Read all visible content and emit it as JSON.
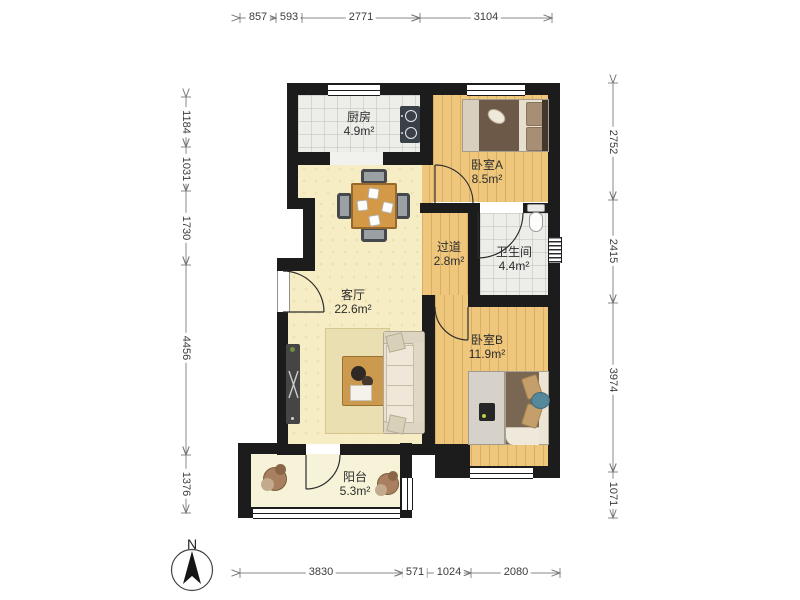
{
  "figure": {
    "type": "apartment-floor-plan"
  },
  "rooms": [
    {
      "id": "kitchen",
      "name": "厨房",
      "area": "4.9m²"
    },
    {
      "id": "bedroom-a",
      "name": "卧室A",
      "area": "8.5m²"
    },
    {
      "id": "hallway",
      "name": "过道",
      "area": "2.8m²"
    },
    {
      "id": "bathroom",
      "name": "卫生间",
      "area": "4.4m²"
    },
    {
      "id": "living-room",
      "name": "客厅",
      "area": "22.6m²"
    },
    {
      "id": "bedroom-b",
      "name": "卧室B",
      "area": "11.9m²"
    },
    {
      "id": "balcony",
      "name": "阳台",
      "area": "5.3m²"
    }
  ],
  "dimensions_mm": {
    "top": [
      "857",
      "593",
      "2771",
      "3104"
    ],
    "left": [
      "1184",
      "1031",
      "1730",
      "4456",
      "1376"
    ],
    "right": [
      "2752",
      "2415",
      "3974",
      "1071"
    ],
    "bottom": [
      "3830",
      "571",
      "1024",
      "2080"
    ]
  },
  "compass": {
    "label": "N"
  },
  "colors": {
    "wall": "#1c1c1c",
    "wood_floor": "#efc77c",
    "tile_floor": "#ededea",
    "living_floor": "#f6edc4",
    "balcony_floor": "#f6f3d9",
    "dimension_text": "#3b3b3b",
    "label_text": "#2c2c2c"
  }
}
